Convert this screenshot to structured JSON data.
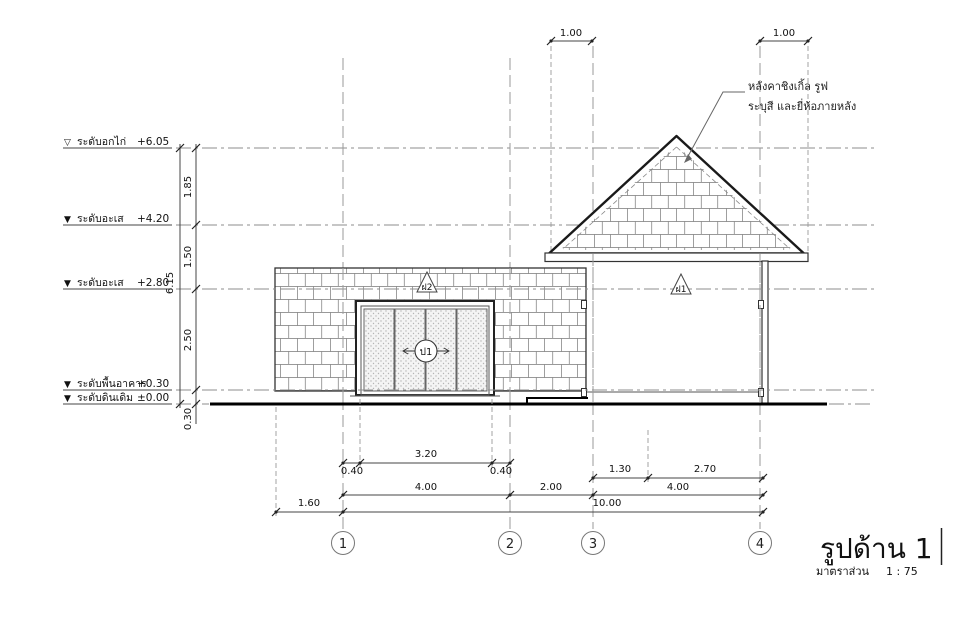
{
  "drawing": {
    "title": "รูปด้าน 1",
    "scale_label": "มาตราส่วน",
    "scale_value": "1 : 75"
  },
  "levels": [
    {
      "marker": "▽",
      "name": "ระดับอกไก่",
      "value": "+6.05"
    },
    {
      "marker": "▼",
      "name": "ระดับอะเส",
      "value": "+4.20"
    },
    {
      "marker": "▼",
      "name": "ระดับอะเส",
      "value": "+2.80"
    },
    {
      "marker": "▼",
      "name": "ระดับพื้นอาคาร",
      "value": "+0.30"
    },
    {
      "marker": "▼",
      "name": "ระดับดินเดิม",
      "value": "±0.00"
    }
  ],
  "dims": {
    "left_total": "6.15",
    "left_segments": [
      "1.85",
      "1.50",
      "2.50",
      "0.30"
    ],
    "top": [
      "1.00",
      "1.00"
    ],
    "door": [
      "0.40",
      "3.20",
      "0.40"
    ],
    "porch": [
      "1.30",
      "2.70"
    ],
    "bays": [
      "4.00",
      "2.00",
      "4.00"
    ],
    "overall": [
      "1.60",
      "10.00"
    ]
  },
  "grids": [
    "1",
    "2",
    "3",
    "4"
  ],
  "tags": {
    "door": "ป1",
    "wall_front": "ฝ2",
    "wall_porch": "ฝ1"
  },
  "notes": {
    "roof_line1": "หลังคาชิงเกิ้ล รูฟ",
    "roof_line2": "ระบุสี และยี่ห้อภายหลัง"
  }
}
